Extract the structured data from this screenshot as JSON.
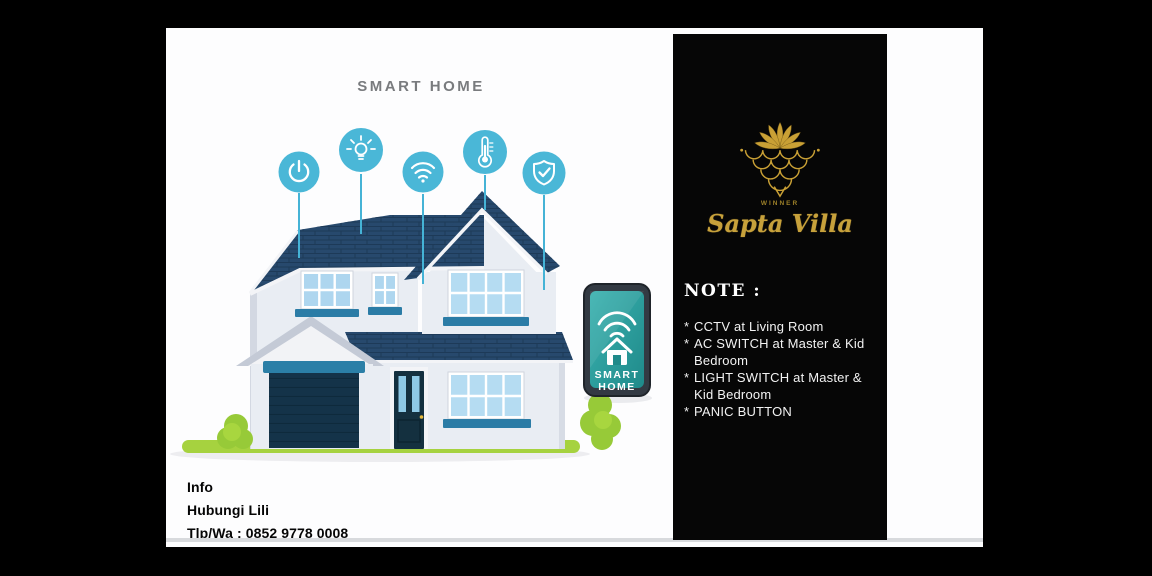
{
  "slide": {
    "title": "SMART HOME",
    "phone": {
      "line1": "SMART",
      "line2": "HOME"
    },
    "info": {
      "lines": [
        "Info",
        "Hubungi Lili",
        "Tlp/Wa : 0852 9778 0008"
      ]
    },
    "icons": [
      {
        "name": "power"
      },
      {
        "name": "lightbulb"
      },
      {
        "name": "wifi"
      },
      {
        "name": "thermometer"
      },
      {
        "name": "shield-check"
      }
    ]
  },
  "card": {
    "brand_small": "WINNER",
    "brand": "Sapta Villa",
    "note_title": "NOTE :",
    "bullet": "*",
    "notes": [
      "CCTV at Living Room",
      "AC SWITCH at Master & Kid Bedroom",
      "LIGHT SWITCH at Master & Kid Bedroom",
      "PANIC BUTTON"
    ]
  },
  "colors": {
    "background": "#000000",
    "slide_bg": "#fdfdfe",
    "card_bg": "#060606",
    "icon_teal": "#4ab7d7",
    "phone_screen_teal": "#2ba4a3",
    "roof_navy": "#27496d",
    "sill_teal": "#2b7ca6",
    "grass_green": "#a6d23f",
    "gold": "#c9a43a",
    "title_gray": "#797b7e"
  }
}
